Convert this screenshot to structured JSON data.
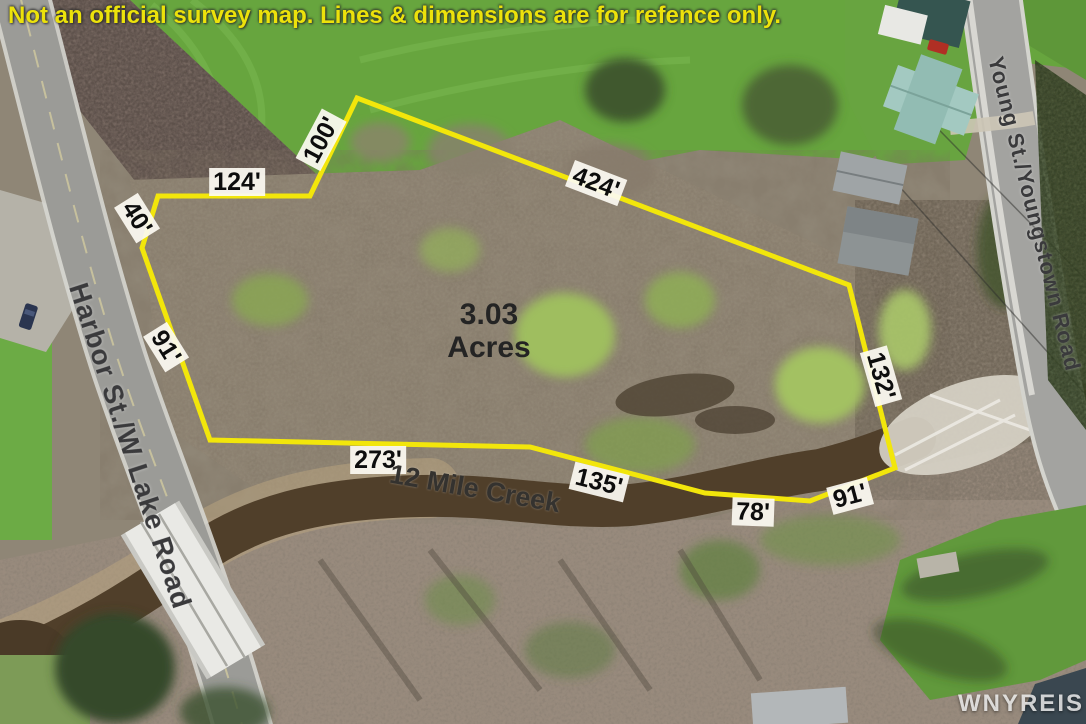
{
  "disclaimer": "Not an official survey map. Lines & dimensions are for refence only.",
  "parcel": {
    "area": {
      "value": "3.03",
      "unit": "Acres"
    },
    "boundary_color": "#f2e60b",
    "dimensions": {
      "d100": "100'",
      "d124": "124'",
      "d40": "40'",
      "d424": "424'",
      "d91w": "91'",
      "d132": "132'",
      "d273": "273'",
      "d135": "135'",
      "d78": "78'",
      "d91s": "91'"
    }
  },
  "roads": {
    "west_road": "Harbor St./W Lake Road",
    "east_road": "Young St./Youngstown Road"
  },
  "water": {
    "creek_name": "12 Mile Creek"
  },
  "watermark": "WNYREIS"
}
